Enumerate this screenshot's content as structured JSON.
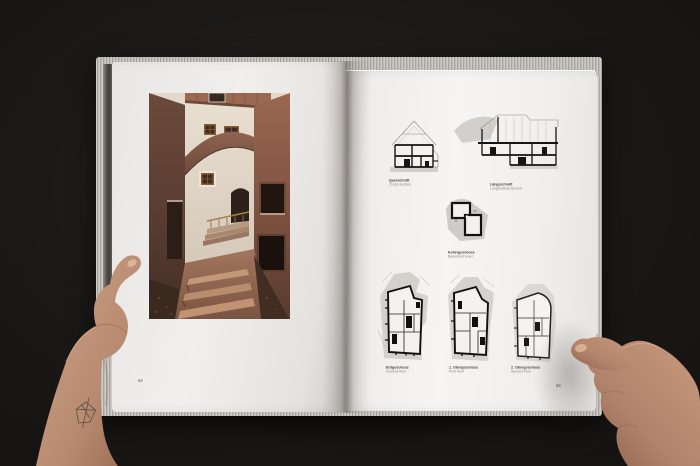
{
  "book": {
    "left_page": {
      "page_number": "64"
    },
    "right_page": {
      "page_number": "65",
      "figures": [
        {
          "id": "cross-section",
          "label_de": "Querschnitt",
          "label_en": "Cross section"
        },
        {
          "id": "longitudinal-section",
          "label_de": "Längsschnitt",
          "label_en": "Longitudinal section"
        },
        {
          "id": "basement-plan",
          "label_de": "Kellergeschoss",
          "label_en": "Basement level"
        },
        {
          "id": "ground-floor-plan",
          "label_de": "Erdgeschoss",
          "label_en": "Ground floor"
        },
        {
          "id": "first-floor-plan",
          "label_de": "1. Obergeschoss",
          "label_en": "First floor"
        },
        {
          "id": "second-floor-plan",
          "label_de": "2. Obergeschoss",
          "label_en": "Second floor"
        }
      ]
    }
  },
  "palette": {
    "background": "#1b1917",
    "page": "#f2f0ee",
    "drawing_ink": "#151515",
    "drawing_shade": "#c9c6c2",
    "photo_wall_dark": "#52392e",
    "photo_wall_light": "#93604b",
    "skin": "#c49a80"
  }
}
